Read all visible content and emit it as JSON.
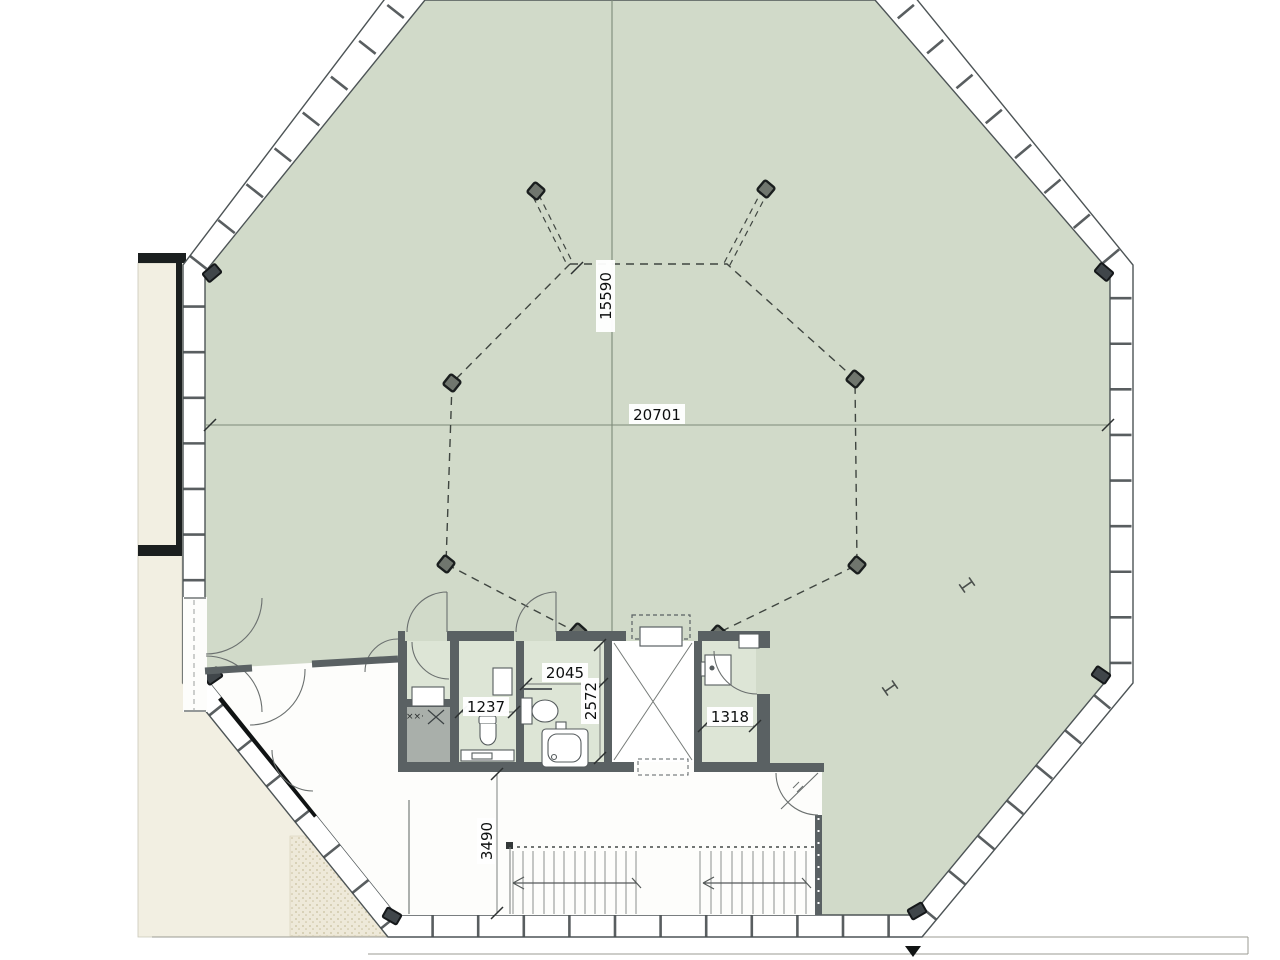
{
  "plan": {
    "title": "Octagonal building floor plan",
    "dims": {
      "height_inner": "15590",
      "width_inner": "20701",
      "bath_w": "2045",
      "bath_d": "2572",
      "wc_w": "1237",
      "store_w": "1318",
      "hall_d": "3490"
    },
    "shaft_marks": "××·",
    "colors": {
      "floor_green": "#d1dac9",
      "room_green": "#dde5d6",
      "wall_dark": "#5a6163",
      "cream": "#f2efe2",
      "stipple_dot": "#c9c09f",
      "line_gray": "#4d5456",
      "centerline": "#7d8a79"
    }
  }
}
